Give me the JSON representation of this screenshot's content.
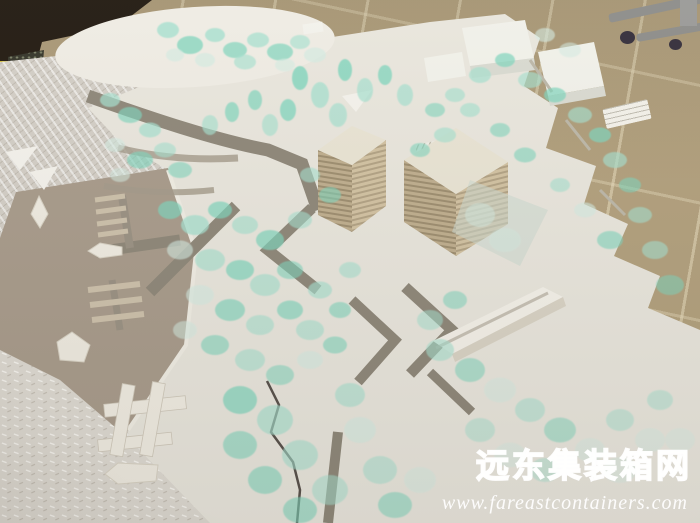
{
  "meta": {
    "description": "Photograph of a white architectural scale model with translucent mint tree discs, zig-zag mid-rise buildings, gray roads, a taupe water area with boats and piers; the model sits on crinkled packing foam with a beige tiled floor and an office-chair caster base visible beyond; red-free white watermark in the lower right corner."
  },
  "watermark": {
    "title": "远东集装箱网",
    "url": "www.fareastcontainers.com"
  },
  "palette": {
    "floor_tan": "#b2a07d",
    "dark_corner": "#221a11",
    "yellow_strip": "#d4be2e",
    "chair_leg": "#8d8d8a",
    "caster": "#352f3b",
    "foam": "#d3cec6",
    "board_white": "#e9e6dd",
    "water_taupe": "#a89b8b",
    "road_gray": "#8e8779",
    "crack": "#57504a"
  },
  "scene": {
    "tree_colors": [
      "#7fd5bd",
      "#a6e0cf",
      "#d4ebe2",
      "#eaf4ef"
    ],
    "trees": [
      [
        168,
        30,
        22,
        16,
        0.8,
        1
      ],
      [
        190,
        45,
        26,
        18,
        0.75,
        0
      ],
      [
        215,
        35,
        20,
        14,
        0.8,
        1
      ],
      [
        235,
        50,
        24,
        16,
        0.7,
        0
      ],
      [
        258,
        40,
        22,
        15,
        0.75,
        1
      ],
      [
        280,
        52,
        26,
        17,
        0.7,
        0
      ],
      [
        300,
        42,
        20,
        14,
        0.65,
        1
      ],
      [
        315,
        55,
        22,
        15,
        0.7,
        2
      ],
      [
        205,
        60,
        20,
        14,
        0.7,
        2
      ],
      [
        245,
        62,
        22,
        15,
        0.65,
        1
      ],
      [
        285,
        65,
        20,
        13,
        0.6,
        2
      ],
      [
        175,
        55,
        18,
        13,
        0.65,
        2
      ],
      [
        300,
        78,
        16,
        24,
        0.8,
        0
      ],
      [
        320,
        95,
        18,
        26,
        0.75,
        1
      ],
      [
        345,
        70,
        14,
        22,
        0.8,
        0
      ],
      [
        365,
        90,
        16,
        24,
        0.7,
        1
      ],
      [
        385,
        75,
        14,
        20,
        0.75,
        0
      ],
      [
        405,
        95,
        16,
        22,
        0.7,
        1
      ],
      [
        288,
        110,
        16,
        22,
        0.75,
        0
      ],
      [
        338,
        115,
        18,
        24,
        0.7,
        1
      ],
      [
        255,
        100,
        14,
        20,
        0.7,
        0
      ],
      [
        270,
        125,
        16,
        22,
        0.65,
        1
      ],
      [
        232,
        112,
        14,
        20,
        0.7,
        0
      ],
      [
        210,
        125,
        16,
        20,
        0.65,
        1
      ],
      [
        110,
        100,
        20,
        14,
        0.7,
        1
      ],
      [
        130,
        115,
        24,
        16,
        0.65,
        0
      ],
      [
        150,
        130,
        22,
        15,
        0.7,
        1
      ],
      [
        115,
        145,
        20,
        14,
        0.6,
        2
      ],
      [
        140,
        160,
        26,
        17,
        0.65,
        0
      ],
      [
        165,
        150,
        22,
        15,
        0.6,
        1
      ],
      [
        180,
        170,
        24,
        16,
        0.6,
        0
      ],
      [
        120,
        175,
        20,
        14,
        0.55,
        2
      ],
      [
        170,
        210,
        24,
        18,
        0.7,
        0
      ],
      [
        195,
        225,
        28,
        20,
        0.75,
        1
      ],
      [
        220,
        210,
        24,
        17,
        0.7,
        0
      ],
      [
        245,
        225,
        26,
        18,
        0.65,
        1
      ],
      [
        270,
        240,
        28,
        20,
        0.7,
        0
      ],
      [
        180,
        250,
        26,
        19,
        0.6,
        2
      ],
      [
        210,
        260,
        30,
        22,
        0.65,
        1
      ],
      [
        240,
        270,
        28,
        20,
        0.7,
        0
      ],
      [
        265,
        285,
        30,
        22,
        0.65,
        1
      ],
      [
        290,
        270,
        26,
        18,
        0.6,
        0
      ],
      [
        200,
        295,
        28,
        20,
        0.6,
        2
      ],
      [
        230,
        310,
        30,
        22,
        0.65,
        0
      ],
      [
        260,
        325,
        28,
        20,
        0.6,
        1
      ],
      [
        290,
        310,
        26,
        19,
        0.65,
        0
      ],
      [
        310,
        330,
        28,
        20,
        0.6,
        1
      ],
      [
        185,
        330,
        24,
        18,
        0.55,
        2
      ],
      [
        215,
        345,
        28,
        20,
        0.6,
        0
      ],
      [
        250,
        360,
        30,
        22,
        0.6,
        1
      ],
      [
        280,
        375,
        28,
        20,
        0.55,
        0
      ],
      [
        310,
        360,
        26,
        18,
        0.6,
        2
      ],
      [
        335,
        345,
        24,
        17,
        0.6,
        0
      ],
      [
        320,
        290,
        24,
        17,
        0.65,
        1
      ],
      [
        340,
        310,
        22,
        16,
        0.6,
        0
      ],
      [
        350,
        270,
        22,
        16,
        0.6,
        1
      ],
      [
        310,
        175,
        20,
        15,
        0.6,
        1
      ],
      [
        330,
        195,
        22,
        16,
        0.6,
        0
      ],
      [
        300,
        220,
        24,
        17,
        0.6,
        1
      ],
      [
        420,
        150,
        20,
        14,
        0.6,
        0
      ],
      [
        445,
        135,
        22,
        15,
        0.65,
        1
      ],
      [
        455,
        95,
        20,
        14,
        0.65,
        1
      ],
      [
        435,
        110,
        20,
        14,
        0.6,
        0
      ],
      [
        480,
        75,
        22,
        16,
        0.7,
        1
      ],
      [
        505,
        60,
        20,
        14,
        0.7,
        0
      ],
      [
        530,
        80,
        24,
        16,
        0.65,
        1
      ],
      [
        555,
        95,
        22,
        15,
        0.7,
        0
      ],
      [
        580,
        115,
        24,
        16,
        0.65,
        1
      ],
      [
        600,
        135,
        22,
        15,
        0.7,
        0
      ],
      [
        615,
        160,
        24,
        16,
        0.65,
        1
      ],
      [
        630,
        185,
        22,
        15,
        0.6,
        0
      ],
      [
        640,
        215,
        24,
        16,
        0.6,
        1
      ],
      [
        610,
        240,
        26,
        18,
        0.6,
        0
      ],
      [
        585,
        210,
        22,
        15,
        0.6,
        2
      ],
      [
        560,
        185,
        20,
        14,
        0.6,
        1
      ],
      [
        500,
        130,
        20,
        14,
        0.6,
        0
      ],
      [
        470,
        110,
        20,
        14,
        0.65,
        1
      ],
      [
        525,
        155,
        22,
        15,
        0.6,
        0
      ],
      [
        655,
        250,
        26,
        18,
        0.6,
        1
      ],
      [
        670,
        285,
        28,
        20,
        0.55,
        0
      ],
      [
        545,
        35,
        20,
        14,
        0.6,
        2
      ],
      [
        570,
        50,
        22,
        15,
        0.55,
        2
      ],
      [
        480,
        215,
        30,
        24,
        0.5,
        2
      ],
      [
        505,
        240,
        32,
        24,
        0.45,
        2
      ],
      [
        240,
        400,
        34,
        28,
        0.7,
        0
      ],
      [
        275,
        420,
        36,
        30,
        0.65,
        1
      ],
      [
        240,
        445,
        34,
        28,
        0.6,
        0
      ],
      [
        300,
        455,
        36,
        30,
        0.6,
        1
      ],
      [
        265,
        480,
        34,
        28,
        0.6,
        0
      ],
      [
        330,
        490,
        36,
        30,
        0.55,
        1
      ],
      [
        300,
        510,
        34,
        26,
        0.6,
        0
      ],
      [
        360,
        430,
        32,
        26,
        0.6,
        2
      ],
      [
        380,
        470,
        34,
        28,
        0.55,
        1
      ],
      [
        350,
        395,
        30,
        24,
        0.6,
        1
      ],
      [
        395,
        505,
        34,
        26,
        0.55,
        0
      ],
      [
        420,
        480,
        32,
        26,
        0.5,
        2
      ],
      [
        440,
        350,
        28,
        22,
        0.6,
        1
      ],
      [
        470,
        370,
        30,
        24,
        0.55,
        0
      ],
      [
        500,
        390,
        32,
        25,
        0.5,
        2
      ],
      [
        530,
        410,
        30,
        24,
        0.55,
        1
      ],
      [
        560,
        430,
        32,
        25,
        0.5,
        0
      ],
      [
        590,
        450,
        30,
        24,
        0.45,
        2
      ],
      [
        620,
        420,
        28,
        22,
        0.5,
        1
      ],
      [
        650,
        440,
        30,
        24,
        0.45,
        2
      ],
      [
        480,
        430,
        30,
        24,
        0.5,
        1
      ],
      [
        510,
        455,
        32,
        25,
        0.45,
        2
      ],
      [
        545,
        470,
        30,
        24,
        0.45,
        1
      ],
      [
        620,
        470,
        34,
        26,
        0.4,
        2
      ],
      [
        660,
        400,
        26,
        20,
        0.5,
        1
      ],
      [
        680,
        440,
        30,
        24,
        0.4,
        2
      ],
      [
        455,
        300,
        24,
        18,
        0.55,
        0
      ],
      [
        430,
        320,
        26,
        20,
        0.55,
        1
      ]
    ]
  }
}
